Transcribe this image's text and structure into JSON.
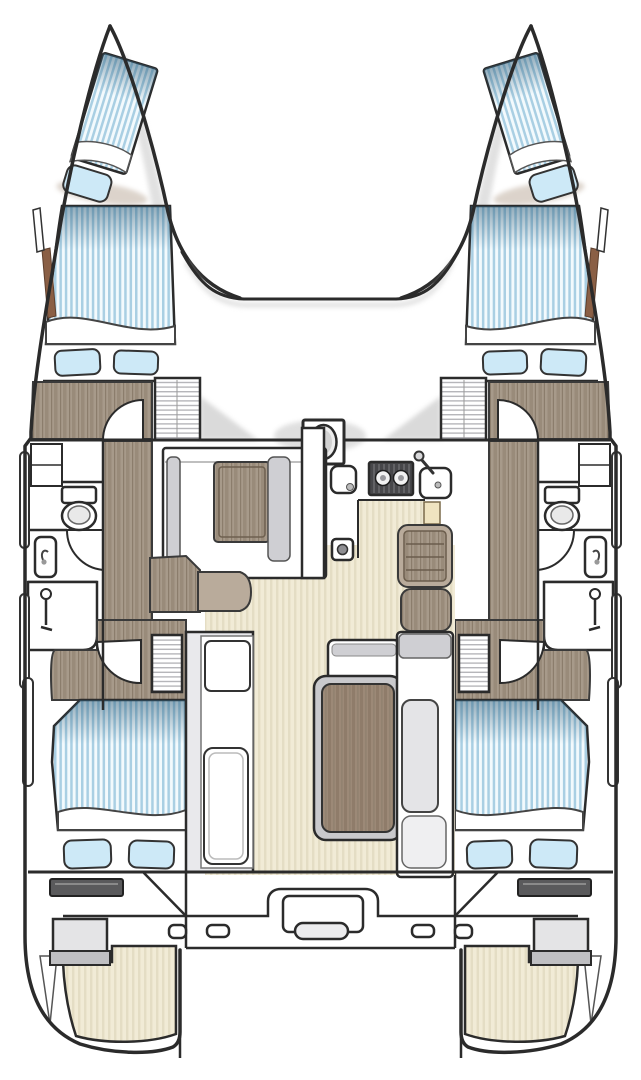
{
  "diagram": {
    "title": "catamaran-interior-floor-plan",
    "type": "boat-floor-plan",
    "view": "top-down",
    "orientation": "bow-up",
    "hull_count": 2,
    "symmetry": "port-starboard-mirrored"
  },
  "colors": {
    "outline": "#2b2b2b",
    "wall": "#333333",
    "hull_fill": "#ffffff",
    "mattress_base": "#f3fafd",
    "mattress_stripe": "#a9cfe3",
    "mattress_shade": "#2f5d79",
    "pillow": "#cde9f7",
    "wood_floor": "#a79a8a",
    "wood_grain": "#998b7a",
    "wood_grain_dark": "#8b7d6c",
    "table_wood": "#9c8977",
    "table_grain": "#8f7c6a",
    "deck_beige": "#f1ebd6",
    "deck_stripe": "#e4ddc4",
    "furniture_gray": "#e9e9ec",
    "furniture_gray_dark": "#cfcfd3",
    "table_rim_gray": "#c9c9cc",
    "stove_black": "#47474a",
    "burner_white": "#f2f2f2",
    "shadow_gray": "#cbcbcb",
    "step_dark": "#5a5a5c",
    "box_gray": "#e4e4e6",
    "box_lip_gray": "#bfbfc2",
    "louver_line": "#b6b6ba",
    "rubrail_brown": "#8a5f45",
    "taupe_seat": "#b9ab9b",
    "kettle_beige": "#efe3c0"
  },
  "port_hull": {
    "name": "port-hull",
    "spaces": [
      {
        "name": "forepeak-berth",
        "fixtures": [
          "striped-mattress",
          "pillow"
        ]
      },
      {
        "name": "forward-cabin",
        "fixtures": [
          "double-berth-mattress",
          "pillow",
          "pillow",
          "shelf-unit",
          "louvered-hatch",
          "wood-floor",
          "door-swing"
        ]
      },
      {
        "name": "mid-hull-bathroom",
        "fixtures": [
          "toilet",
          "vanity-sink",
          "shower-enclosure",
          "shower-head",
          "door-swing"
        ]
      },
      {
        "name": "corridor",
        "fixtures": [
          "wood-floor"
        ]
      },
      {
        "name": "aft-cabin",
        "fixtures": [
          "double-berth-mattress",
          "pillow",
          "pillow",
          "louvered-locker",
          "wood-floor",
          "door-swing"
        ]
      },
      {
        "name": "transom",
        "fixtures": [
          "step-bar",
          "storage-box",
          "swim-platform"
        ]
      }
    ],
    "exterior": [
      "rubrail-strip",
      "rubrail-strip",
      "bow-wood-strip",
      "aft-rail-strip"
    ]
  },
  "starboard_hull": {
    "name": "starboard-hull",
    "mirror_of": "port-hull"
  },
  "salon": {
    "name": "main-deck-salon",
    "fixtures": [
      {
        "name": "mast-post"
      },
      {
        "name": "galley",
        "items": [
          "galley-sink",
          "two-burner-stove",
          "sink-with-faucet",
          "small-appliance",
          "cutting-board-kettle"
        ]
      },
      {
        "name": "forward-settee",
        "items": [
          "bench-seat",
          "coffee-table",
          "bench-seat",
          "partition-wall"
        ]
      },
      {
        "name": "companionway-steps-port"
      },
      {
        "name": "companionway-steps-starboard"
      },
      {
        "name": "dining-area",
        "items": [
          "side-bench",
          "dining-table",
          "forward-bench",
          "l-shaped-bench"
        ]
      },
      {
        "name": "louvered-hatch-port"
      },
      {
        "name": "louvered-hatch-starboard"
      }
    ]
  },
  "cockpit": {
    "name": "aft-cockpit",
    "fixtures": [
      "transom-beam",
      "engine-hatch-module",
      "hatch-handle",
      "cleat",
      "cleat",
      "cleat",
      "cleat"
    ]
  },
  "foredeck": {
    "name": "foredeck-bridgedeck",
    "fixtures": [
      "coachroof-front-curve"
    ]
  }
}
